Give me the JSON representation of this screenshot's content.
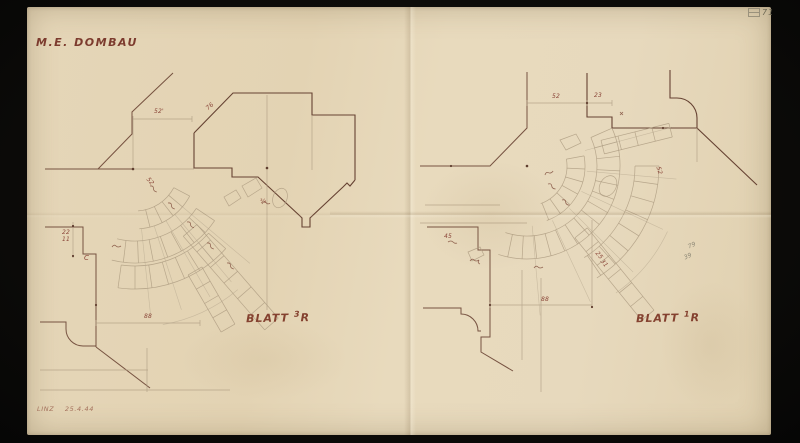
{
  "meta": {
    "title": "M.E. DOMBAU",
    "date_note": "LINZ 25.4.44",
    "archive_number": "71"
  },
  "sheets": {
    "left": {
      "label_word": "BLATT",
      "label_num": "3",
      "label_letter": "R"
    },
    "right": {
      "label_word": "BLATT",
      "label_num": "1",
      "label_letter": "R"
    }
  },
  "annotations": {
    "left": [
      {
        "text": "52'"
      },
      {
        "text": "76"
      },
      {
        "text": "52"
      },
      {
        "text": "22"
      },
      {
        "text": "11"
      },
      {
        "text": "C"
      },
      {
        "text": "88"
      },
      {
        "text": "¾"
      }
    ],
    "right": [
      {
        "text": "52"
      },
      {
        "text": "23"
      },
      {
        "text": "52"
      },
      {
        "text": "45"
      },
      {
        "text": "88"
      },
      {
        "text": "79"
      },
      {
        "text": "39"
      },
      {
        "text": "25"
      },
      {
        "text": "31"
      }
    ]
  },
  "colors": {
    "background": "#0b0a08",
    "paper": "#e6d8bb",
    "ink": "#6d4636",
    "pencil": "#ab9a80",
    "label_red": "#84412f"
  }
}
